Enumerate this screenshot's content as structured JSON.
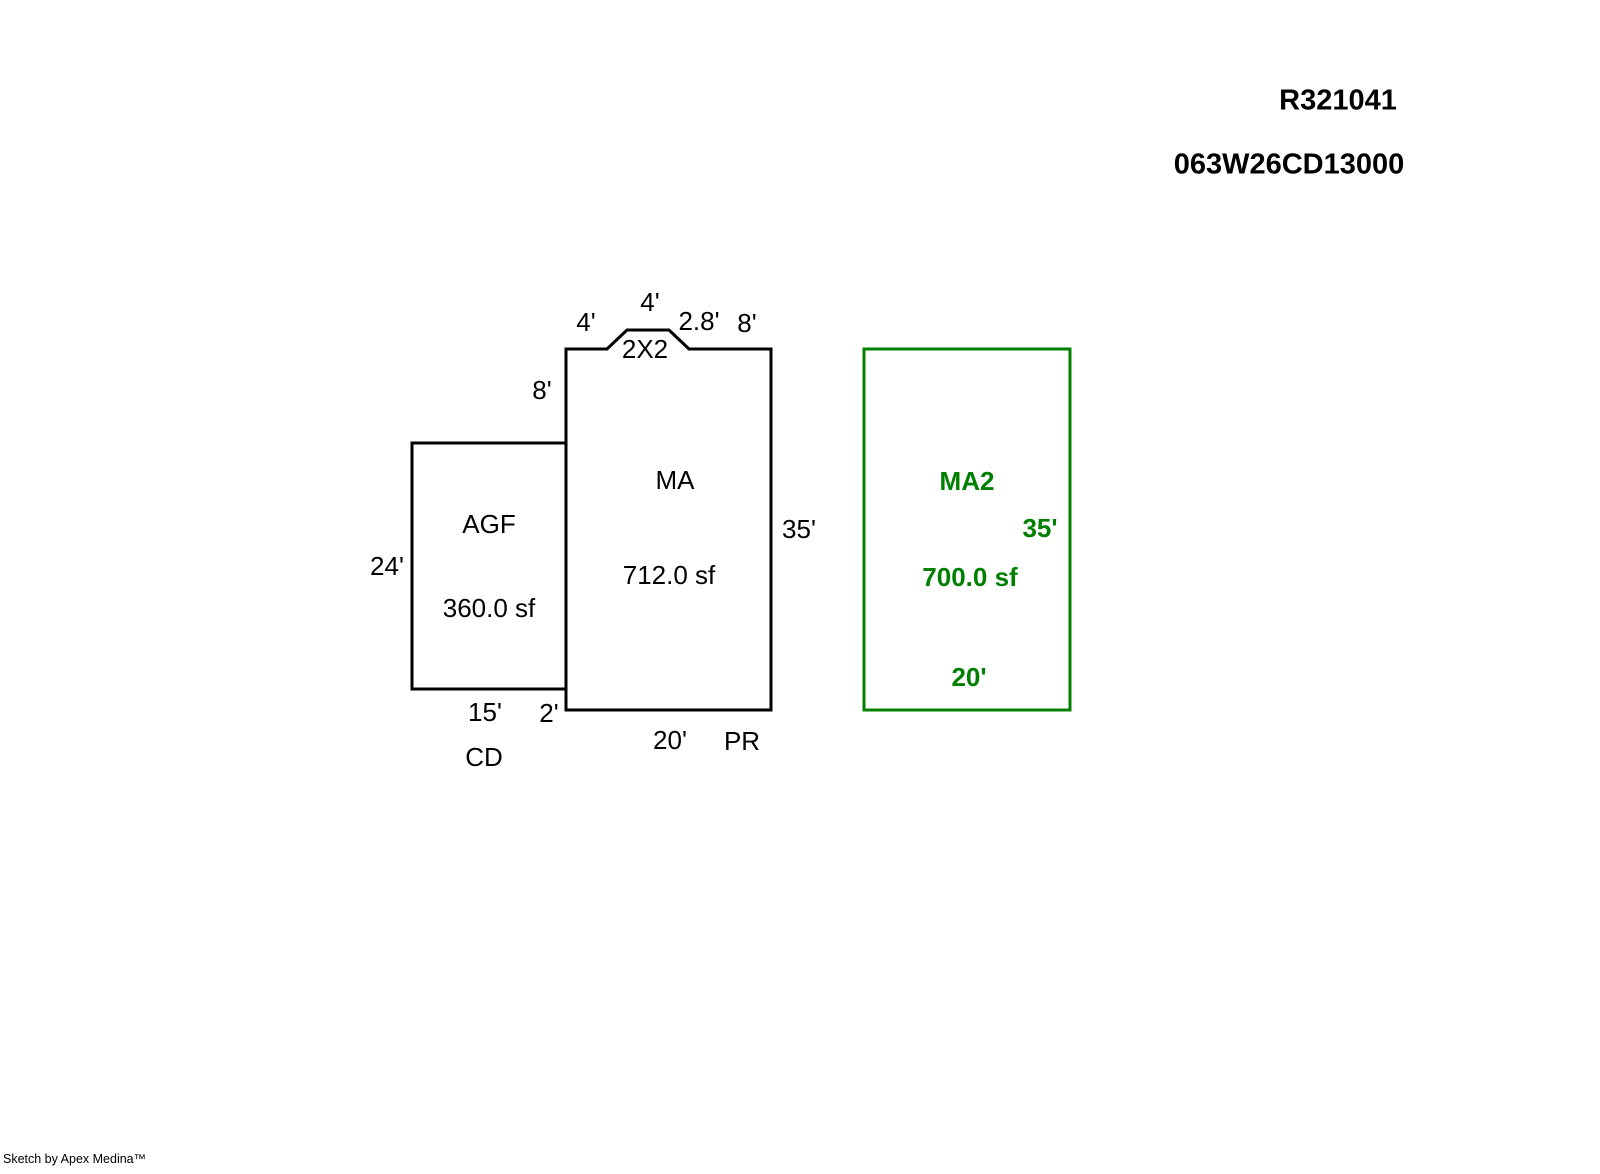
{
  "header": {
    "record_id": "R321041",
    "parcel_id": "063W26CD13000"
  },
  "sketch": {
    "areas": {
      "agf": {
        "code": "AGF",
        "area": "360.0 sf",
        "left_dim": "24'",
        "bottom_dim": "15'",
        "bottom_code": "CD"
      },
      "ma": {
        "code": "MA",
        "area": "712.0 sf",
        "right_dim": "35'",
        "bottom_dim": "20'",
        "bottom_code": "PR",
        "left_upper_dim": "8'",
        "left_lower_dim": "2'",
        "notch": {
          "label": "2X2",
          "left_h_dim": "4'",
          "top_dim": "4'",
          "right_diag_dim": "2.8'",
          "right_h_dim": "8'"
        }
      },
      "ma2": {
        "code": "MA2",
        "area": "700.0 sf",
        "right_dim": "35'",
        "bottom_dim": "20'"
      }
    }
  },
  "footer": {
    "credit": "Sketch by Apex Medina™"
  },
  "colors": {
    "accent_green": "#008000",
    "line_color": "#000000"
  }
}
